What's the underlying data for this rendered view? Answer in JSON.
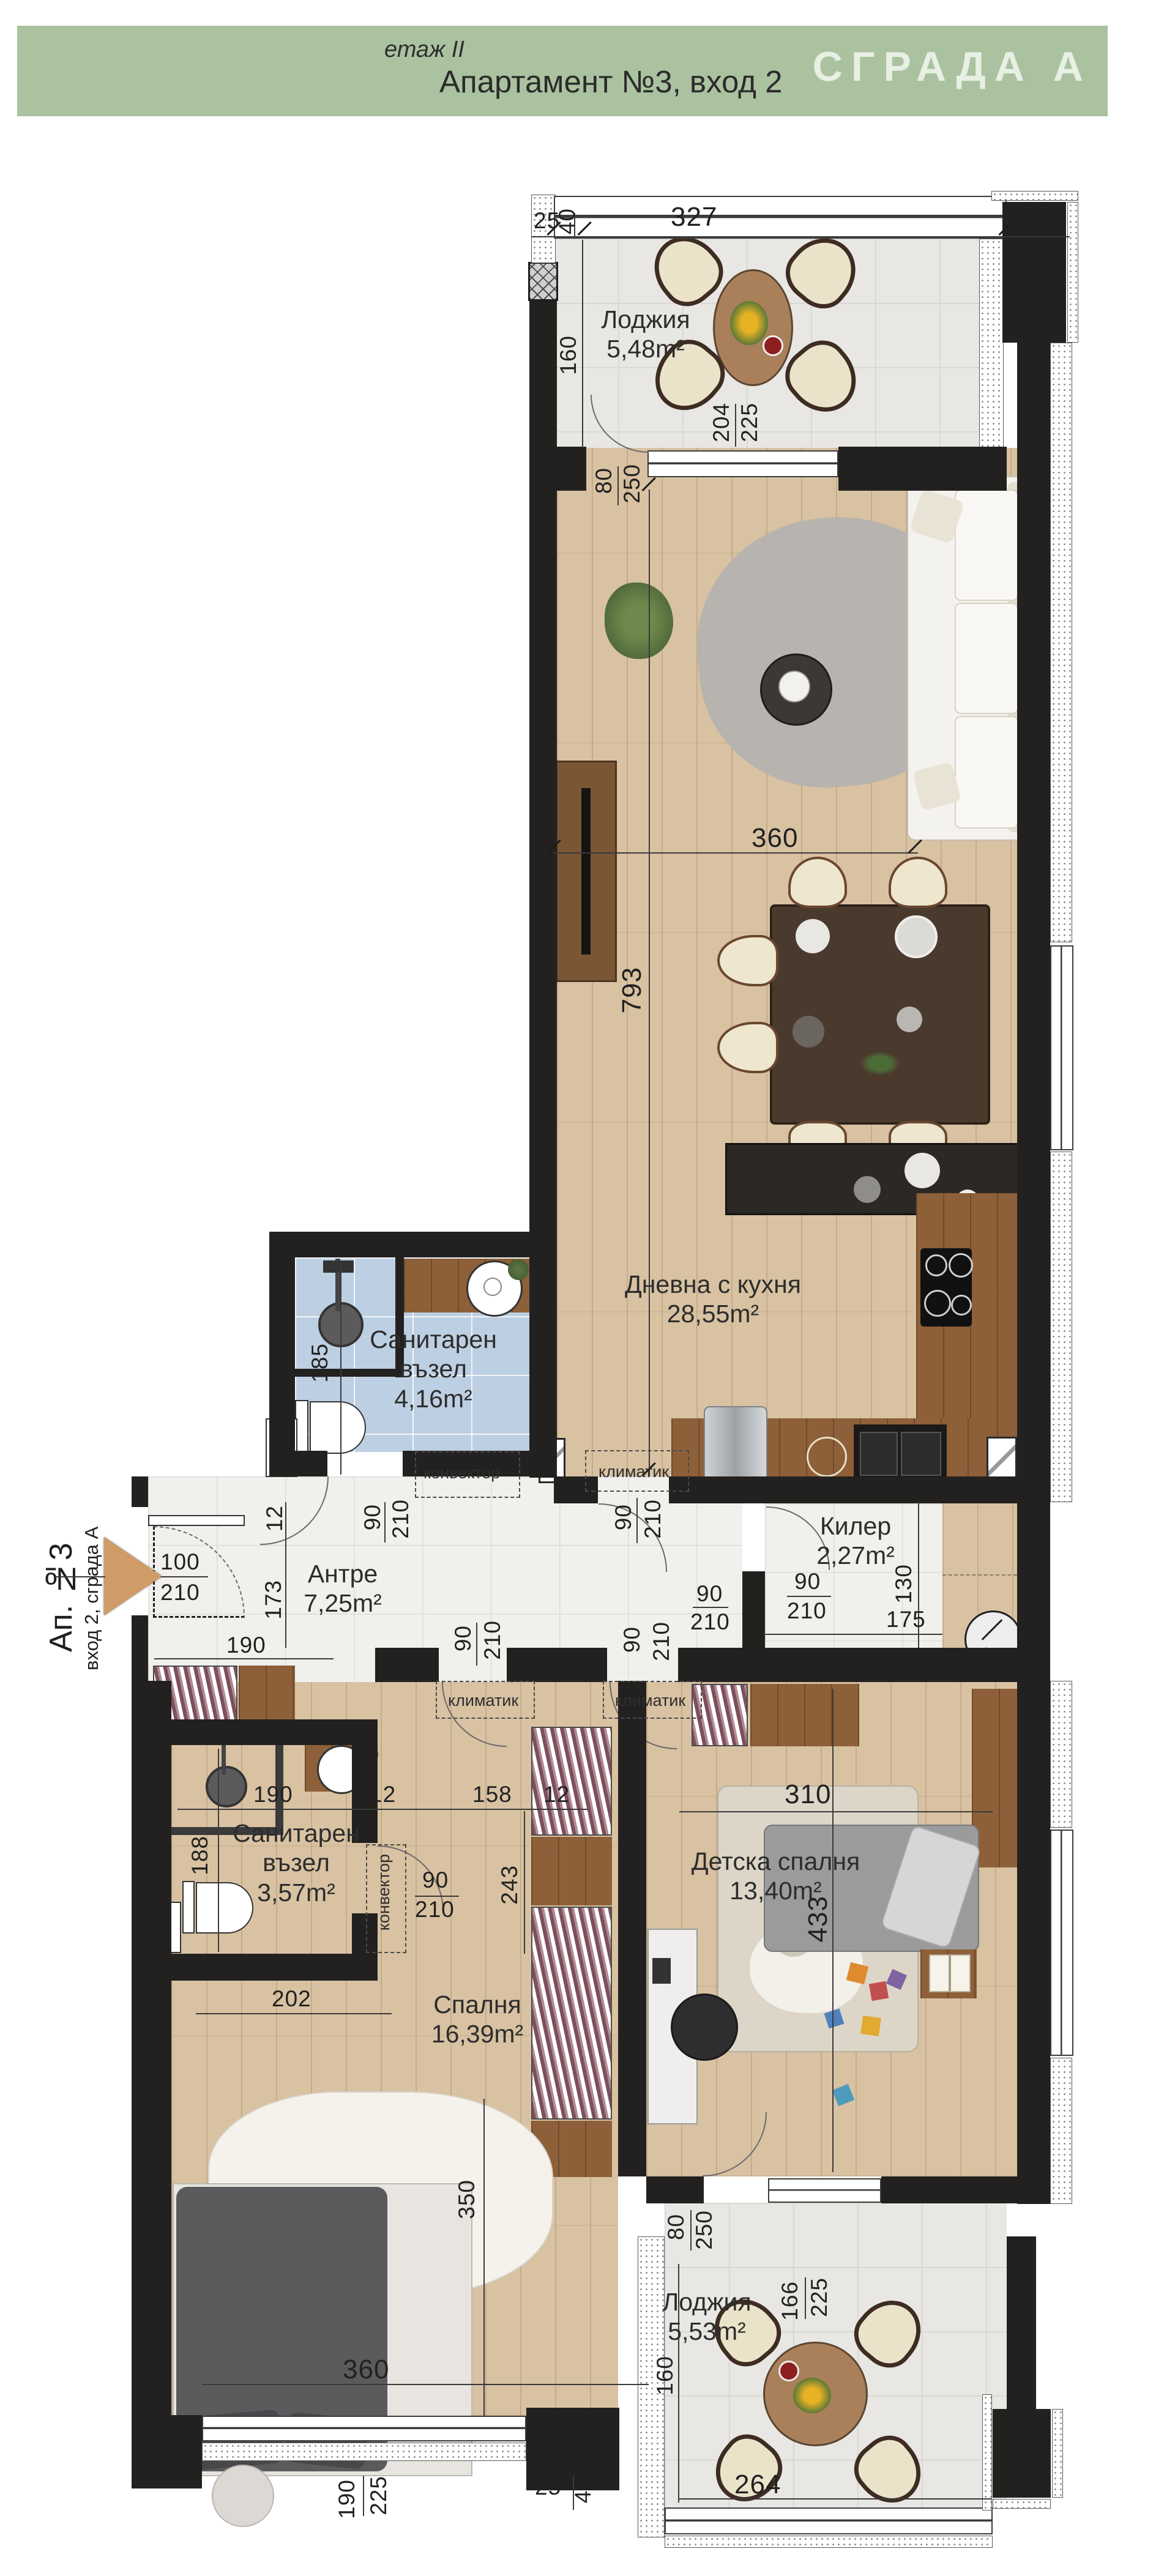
{
  "header": {
    "floor": "етаж II",
    "title": "Апартамент №3, вход 2",
    "building": "СГРАДА А"
  },
  "entry": {
    "apartment": "Ап. №3",
    "sub": "вход 2, сграда А"
  },
  "rooms": {
    "loggia_top": {
      "name": "Лоджия",
      "area": "5,48m²"
    },
    "living": {
      "name": "Дневна с кухня",
      "area": "28,55m²"
    },
    "bath1": {
      "name": "Санитарен възел",
      "area": "4,16m²"
    },
    "antre": {
      "name": "Антре",
      "area": "7,25m²"
    },
    "kiler": {
      "name": "Килер",
      "area": "2,27m²"
    },
    "bath2": {
      "name": "Санитарен възел",
      "area": "3,57m²"
    },
    "bedroom": {
      "name": "Спалня",
      "area": "16,39m²"
    },
    "kids": {
      "name": "Детска спалня",
      "area": "13,40m²"
    },
    "loggia_bottom": {
      "name": "Лоджия",
      "area": "5,53m²"
    }
  },
  "labels": {
    "convector": "конвектор",
    "climatic": "климатик"
  },
  "dims": {
    "n25": "25",
    "n40": "40",
    "n327": "327",
    "n160": "160",
    "n204": "204",
    "n225": "225",
    "n80": "80",
    "n250": "250",
    "n360": "360",
    "n793": "793",
    "n185": "185",
    "n100": "100",
    "n210": "210",
    "n90": "90",
    "n12": "12",
    "n173": "173",
    "n190": "190",
    "n130": "130",
    "n175": "175",
    "n188": "188",
    "n202": "202",
    "n158": "158",
    "n243": "243",
    "n310": "310",
    "n433": "433",
    "n350": "350",
    "n264": "264",
    "n166": "166"
  },
  "colors": {
    "banner": "#aac2a0",
    "banner_text": "#e8efe3",
    "wall": "#232120",
    "wood_floor": "#d8c2a2",
    "counter_wood": "#8d6039",
    "tile_floor": "#e8e7e3",
    "bath_tile": "#bdcfe2",
    "entry_arrow": "#cf9c67"
  }
}
